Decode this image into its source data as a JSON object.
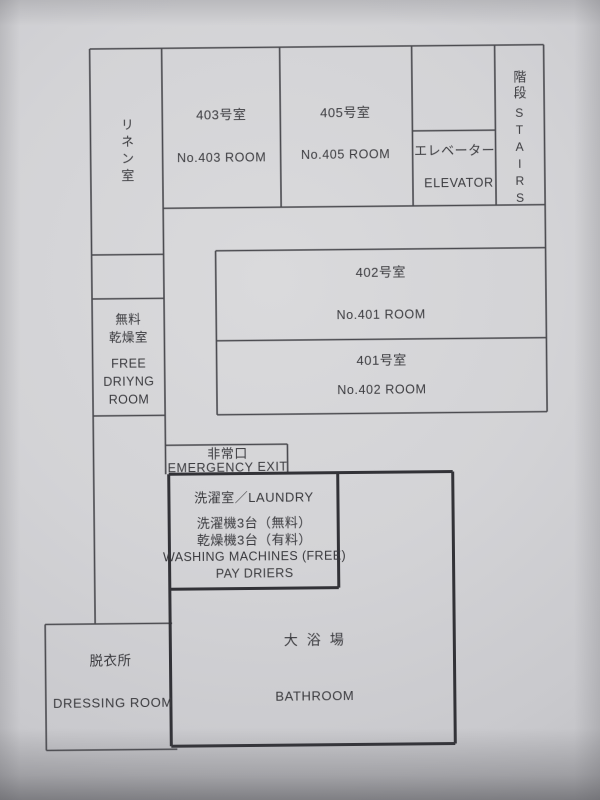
{
  "document": {
    "kind": "hotel-floor-plan",
    "floor": "4F"
  },
  "rooms": {
    "linen": {
      "jp": "リネン室"
    },
    "room403": {
      "jp": "403号室",
      "en": "No.403 ROOM"
    },
    "room405": {
      "jp": "405号室",
      "en": "No.405 ROOM"
    },
    "elevator": {
      "jp": "エレベーター",
      "en": "ELEVATOR"
    },
    "stairs": {
      "jp": "階段",
      "en": "STAIRS"
    },
    "room402": {
      "jp": "402号室",
      "en": "No.401 ROOM"
    },
    "room401": {
      "jp": "401号室",
      "en": "No.402 ROOM"
    },
    "drying": {
      "jp1": "無料",
      "jp2": "乾燥室",
      "en1": "FREE",
      "en2": "DRIYNG",
      "en3": "ROOM"
    },
    "emergency_exit": {
      "jp": "非常口",
      "en": "EMERGENCY EXIT"
    },
    "laundry": {
      "title": "洗濯室／LAUNDRY",
      "jp1": "洗濯機3台（無料）",
      "jp2": "乾燥機3台（有料）",
      "en1": "WASHING MACHINES (FREE)",
      "en2": "PAY DRIERS"
    },
    "dressing": {
      "jp": "脱衣所",
      "en": "DRESSING ROOM"
    },
    "bath": {
      "jp": "大浴場",
      "en": "BATHROOM"
    }
  },
  "colors": {
    "paper": "#d3d3d6",
    "wall_thin": "#4a4a4f",
    "wall_thick": "#323237",
    "text": "#3a3a3e"
  }
}
